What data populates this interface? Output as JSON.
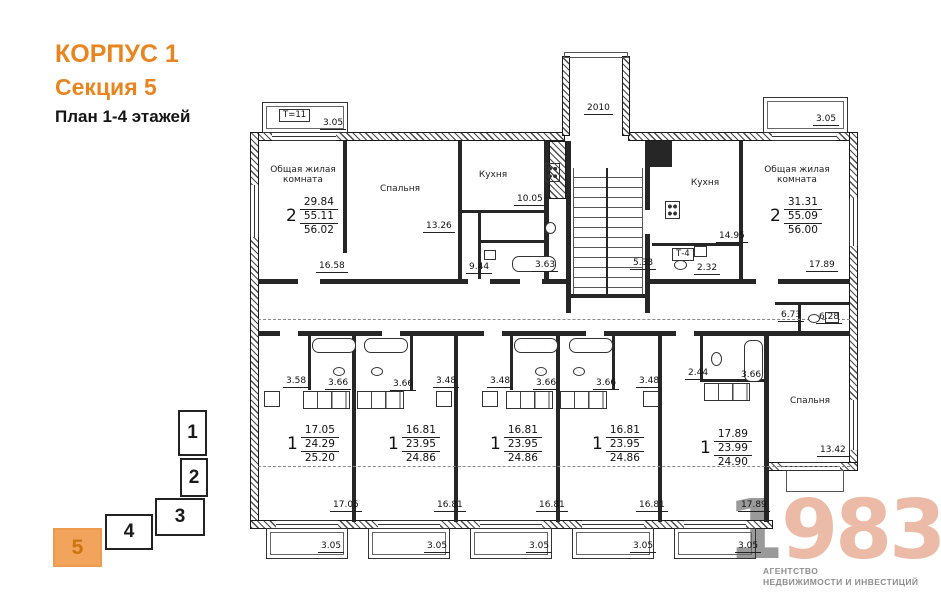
{
  "header": {
    "building": "КОРПУС 1",
    "section": "Секция 5",
    "plan_title": "План 1-4 этажей"
  },
  "colors": {
    "accent_orange": "#E8851F",
    "locator_active_fill": "#F3A45C",
    "locator_active_number": "#CE730D",
    "logo_salmon": "#ECBBA8",
    "logo_gray": "#9A9A9A",
    "plan_line": "#262626"
  },
  "locator": {
    "sections": [
      {
        "label": "1",
        "active": false,
        "x": 178,
        "y": 410,
        "w": 29,
        "h": 46
      },
      {
        "label": "2",
        "active": false,
        "x": 180,
        "y": 458,
        "w": 28,
        "h": 39
      },
      {
        "label": "3",
        "active": false,
        "x": 155,
        "y": 498,
        "w": 50,
        "h": 38
      },
      {
        "label": "4",
        "active": false,
        "x": 105,
        "y": 514,
        "w": 48,
        "h": 36
      },
      {
        "label": "5",
        "active": true,
        "x": 53,
        "y": 528,
        "w": 49,
        "h": 39
      }
    ]
  },
  "logo": {
    "digit_gray": "1",
    "digits_accent": "983",
    "caption_line1": "АГЕНТСТВО",
    "caption_line2": "НЕДВИЖИМОСТИ И ИНВЕСТИЦИЙ"
  },
  "plan": {
    "apartments": [
      {
        "rooms": "2",
        "values": [
          "29.84",
          "55.11",
          "56.02"
        ],
        "x": 286,
        "y": 196
      },
      {
        "rooms": "2",
        "values": [
          "31.31",
          "55.09",
          "56.00"
        ],
        "x": 770,
        "y": 196
      },
      {
        "rooms": "1",
        "values": [
          "17.05",
          "24.29",
          "25.20"
        ],
        "x": 287,
        "y": 424
      },
      {
        "rooms": "1",
        "values": [
          "16.81",
          "23.95",
          "24.86"
        ],
        "x": 388,
        "y": 424
      },
      {
        "rooms": "1",
        "values": [
          "16.81",
          "23.95",
          "24.86"
        ],
        "x": 490,
        "y": 424
      },
      {
        "rooms": "1",
        "values": [
          "16.81",
          "23.95",
          "24.86"
        ],
        "x": 592,
        "y": 424
      },
      {
        "rooms": "1",
        "values": [
          "17.89",
          "23.99",
          "24.90"
        ],
        "x": 700,
        "y": 428
      }
    ],
    "room_labels": [
      {
        "lines": [
          "Общая жилая",
          "комната"
        ],
        "x": 258,
        "y": 165,
        "w": 90
      },
      {
        "lines": [
          "Спальня"
        ],
        "x": 370,
        "y": 184,
        "w": 60
      },
      {
        "lines": [
          "Кухня"
        ],
        "x": 468,
        "y": 170,
        "w": 50
      },
      {
        "lines": [
          "Кухня"
        ],
        "x": 680,
        "y": 178,
        "w": 50
      },
      {
        "lines": [
          "Общая жилая",
          "комната"
        ],
        "x": 752,
        "y": 165,
        "w": 90
      },
      {
        "lines": [
          "Спальня"
        ],
        "x": 780,
        "y": 396,
        "w": 60
      }
    ],
    "tag_labels": [
      {
        "text": "Т=11",
        "x": 279,
        "y": 109
      },
      {
        "text": "Т-4",
        "x": 672,
        "y": 248
      }
    ],
    "dim_labels": [
      {
        "text": "3.05",
        "x": 320,
        "y": 118
      },
      {
        "text": "2010",
        "x": 584,
        "y": 103
      },
      {
        "text": "3.05",
        "x": 813,
        "y": 114
      },
      {
        "text": "13.26",
        "x": 423,
        "y": 221
      },
      {
        "text": "10.05",
        "x": 514,
        "y": 194
      },
      {
        "text": "14.95",
        "x": 716,
        "y": 231
      },
      {
        "text": "16.58",
        "x": 316,
        "y": 261
      },
      {
        "text": "9.44",
        "x": 466,
        "y": 262
      },
      {
        "text": "3.63",
        "x": 532,
        "y": 260
      },
      {
        "text": "5.33",
        "x": 630,
        "y": 258
      },
      {
        "text": "2.32",
        "x": 694,
        "y": 263
      },
      {
        "text": "17.89",
        "x": 806,
        "y": 260
      },
      {
        "text": "6.73",
        "x": 778,
        "y": 310
      },
      {
        "text": "6.28",
        "x": 816,
        "y": 312
      },
      {
        "text": "3.58",
        "x": 283,
        "y": 376
      },
      {
        "text": "3.66",
        "x": 325,
        "y": 378
      },
      {
        "text": "3.66",
        "x": 390,
        "y": 379
      },
      {
        "text": "3.48",
        "x": 433,
        "y": 376
      },
      {
        "text": "3.48",
        "x": 487,
        "y": 376
      },
      {
        "text": "3.66",
        "x": 533,
        "y": 378
      },
      {
        "text": "3.66",
        "x": 593,
        "y": 378
      },
      {
        "text": "3.48",
        "x": 636,
        "y": 376
      },
      {
        "text": "2.44",
        "x": 685,
        "y": 368
      },
      {
        "text": "3.66",
        "x": 738,
        "y": 370
      },
      {
        "text": "13.42",
        "x": 817,
        "y": 445
      },
      {
        "text": "17.05",
        "x": 330,
        "y": 500
      },
      {
        "text": "16.81",
        "x": 434,
        "y": 500
      },
      {
        "text": "16.81",
        "x": 536,
        "y": 500
      },
      {
        "text": "16.81",
        "x": 636,
        "y": 500
      },
      {
        "text": "17.89",
        "x": 738,
        "y": 500
      },
      {
        "text": "3.05",
        "x": 318,
        "y": 541
      },
      {
        "text": "3.05",
        "x": 424,
        "y": 541
      },
      {
        "text": "3.05",
        "x": 526,
        "y": 541
      },
      {
        "text": "3.05",
        "x": 630,
        "y": 541
      },
      {
        "text": "3.05",
        "x": 735,
        "y": 541
      }
    ]
  }
}
